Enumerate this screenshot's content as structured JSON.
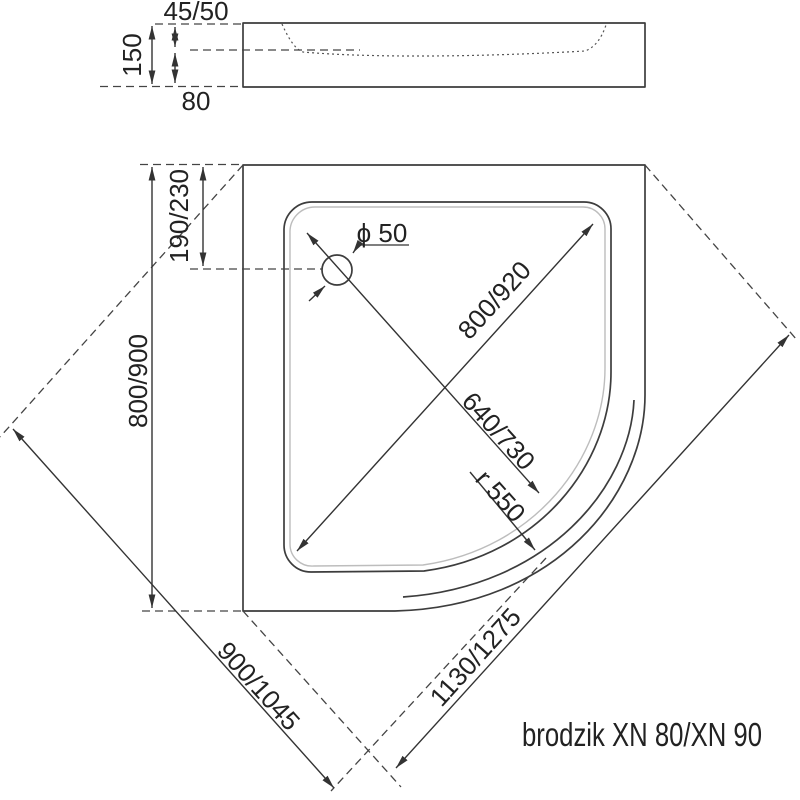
{
  "title": "brodzik XN 80/XN 90",
  "side_view": {
    "dims": {
      "total_height": "150",
      "rim_height": "45/50",
      "base_height": "80"
    }
  },
  "plan_view": {
    "dims": {
      "drain_offset": "190/230",
      "overall_width": "800/900",
      "drain_diameter": "ϕ 50",
      "basin_diagonal": "800/920",
      "drain_diagonal": "640/730",
      "corner_radius": "r 550",
      "left_side": "900/1045",
      "right_side": "1130/1275"
    }
  }
}
